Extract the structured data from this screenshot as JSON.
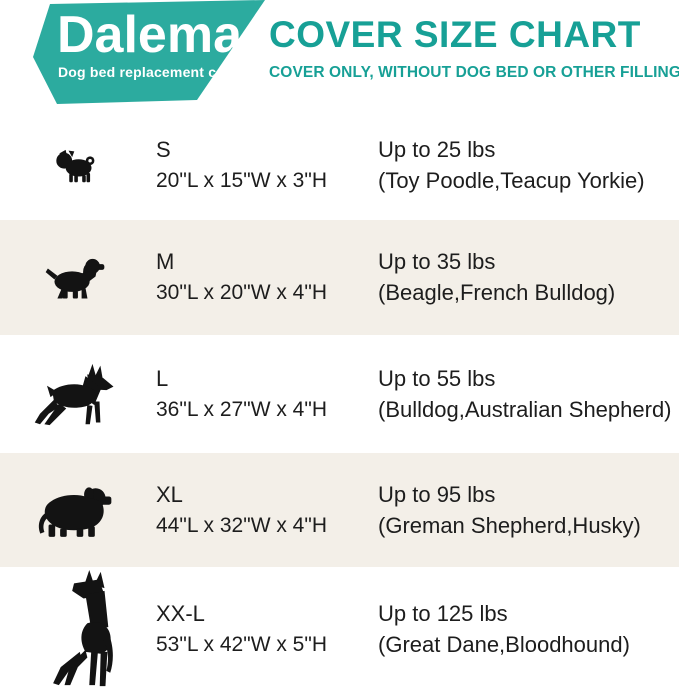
{
  "logo": {
    "brand": "Dalema",
    "tagline": "Dog bed replacement cover"
  },
  "header": {
    "title": "COVER SIZE CHART",
    "subtitle": "COVER ONLY, WITHOUT DOG BED OR OTHER FILLINGS"
  },
  "rows": [
    {
      "size": "S",
      "dimensions": "20\"L x 15\"W x 3\"H",
      "weight": "Up to 25 lbs",
      "breeds": "(Toy Poodle,Teacup Yorkie)",
      "icon": "pug-icon"
    },
    {
      "size": "M",
      "dimensions": "30\"L x 20\"W x 4\"H",
      "weight": "Up to 35 lbs",
      "breeds": "(Beagle,French Bulldog)",
      "icon": "spaniel-icon"
    },
    {
      "size": "L",
      "dimensions": "36\"L x 27\"W x 4\"H",
      "weight": "Up to 55 lbs",
      "breeds": "(Bulldog,Australian Shepherd)",
      "icon": "doberman-icon"
    },
    {
      "size": "XL",
      "dimensions": "44\"L x 32\"W x 4\"H",
      "weight": "Up to 95 lbs",
      "breeds": "(Greman Shepherd,Husky)",
      "icon": "bernese-icon"
    },
    {
      "size": "XX-L",
      "dimensions": "53\"L x 42\"W x 5\"H",
      "weight": "Up to 125 lbs",
      "breeds": "(Great Dane,Bloodhound)",
      "icon": "great-dane-icon"
    }
  ],
  "colors": {
    "banner_teal": "#2cab9f",
    "accent_teal": "#17a096",
    "row_alt_bg": "#f3efe8",
    "text_dark": "#1d1d1d",
    "silhouette_black": "#131313"
  },
  "chart_data": {
    "type": "table",
    "title": "COVER SIZE CHART",
    "subtitle": "COVER ONLY, WITHOUT DOG BED OR OTHER FILLINGS",
    "columns": [
      "Size",
      "Cover dimensions",
      "Weight capacity",
      "Example breeds"
    ],
    "rows": [
      [
        "S",
        "20\"L x 15\"W x 3\"H",
        "Up to 25 lbs",
        "(Toy Poodle,Teacup Yorkie)"
      ],
      [
        "M",
        "30\"L x 20\"W x 4\"H",
        "Up to 35 lbs",
        "(Beagle,French Bulldog)"
      ],
      [
        "L",
        "36\"L x 27\"W x 4\"H",
        "Up to 55 lbs",
        "(Bulldog,Australian Shepherd)"
      ],
      [
        "XL",
        "44\"L x 32\"W x 4\"H",
        "Up to 95 lbs",
        "(Greman Shepherd,Husky)"
      ],
      [
        "XX-L",
        "53\"L x 42\"W x 5\"H",
        "Up to 125 lbs",
        "(Great Dane,Bloodhound)"
      ]
    ]
  }
}
